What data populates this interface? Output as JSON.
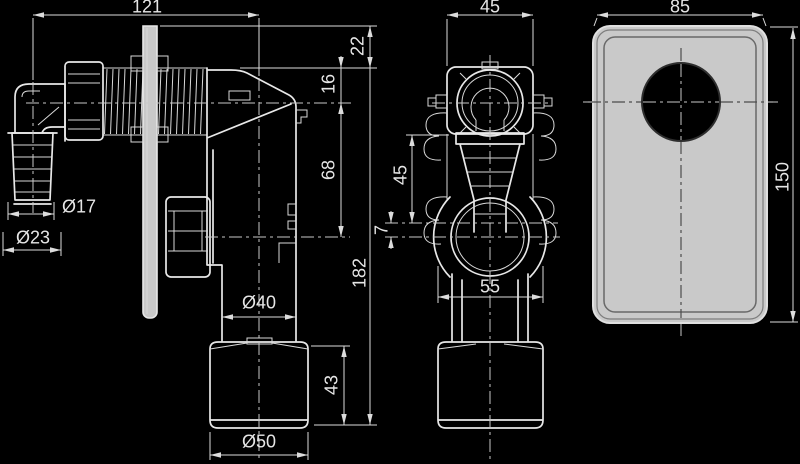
{
  "drawing": {
    "type": "technical-drawing",
    "subject": "wall-mounted washing machine siphon, three orthographic views",
    "colors": {
      "background": "#000000",
      "line": "#e8e8e8",
      "dimension_line": "#dcdcdc",
      "cover_plate_fill": "#c9c9c9",
      "hole_fill": "#000000"
    },
    "labels": {
      "front": {
        "width": "121",
        "plate_top": "22",
        "inlet_top": "16",
        "axis_drop": "68",
        "height": "182",
        "hose_inner": "Ø17",
        "hose_outer": "Ø23",
        "outlet_dia": "Ø40",
        "cup_height": "43",
        "cup_dia": "Ø50"
      },
      "side": {
        "head_width": "45",
        "wall_to_axis": "45",
        "axis_gap": "7",
        "body_width": "55"
      },
      "cover": {
        "width": "85",
        "height": "150"
      }
    }
  }
}
